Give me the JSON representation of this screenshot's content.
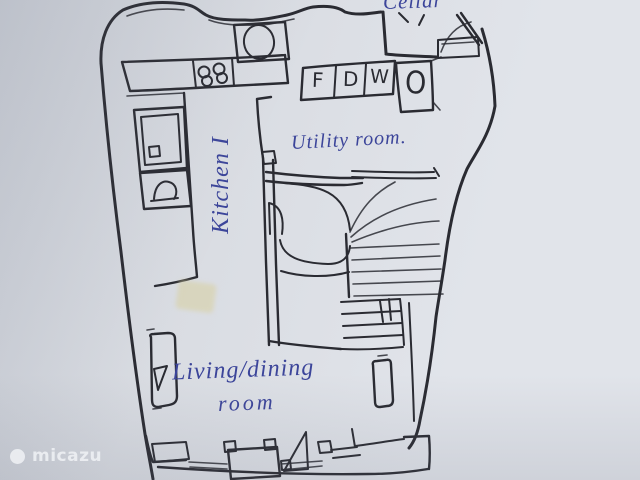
{
  "theme": {
    "paper": "#d9dce2",
    "paper-light": "#e1e4ea",
    "paper-dark": "#ccd0d8",
    "ink": "#2a2b32",
    "ink-blue": "#3c459a",
    "tape": "#d8d0a0",
    "watermark": "#f3f5f8"
  },
  "plan": {
    "labels": {
      "cellar": "Cellar",
      "utility_room": "Utility room.",
      "kitchen": "Kitchen I",
      "living_line1": "Living/dining",
      "living_line2": "room"
    },
    "appliances": [
      {
        "letter": "F"
      },
      {
        "letter": "D"
      },
      {
        "letter": "W"
      },
      {
        "letter": "O"
      }
    ]
  },
  "watermark": {
    "brand": "micazu"
  }
}
